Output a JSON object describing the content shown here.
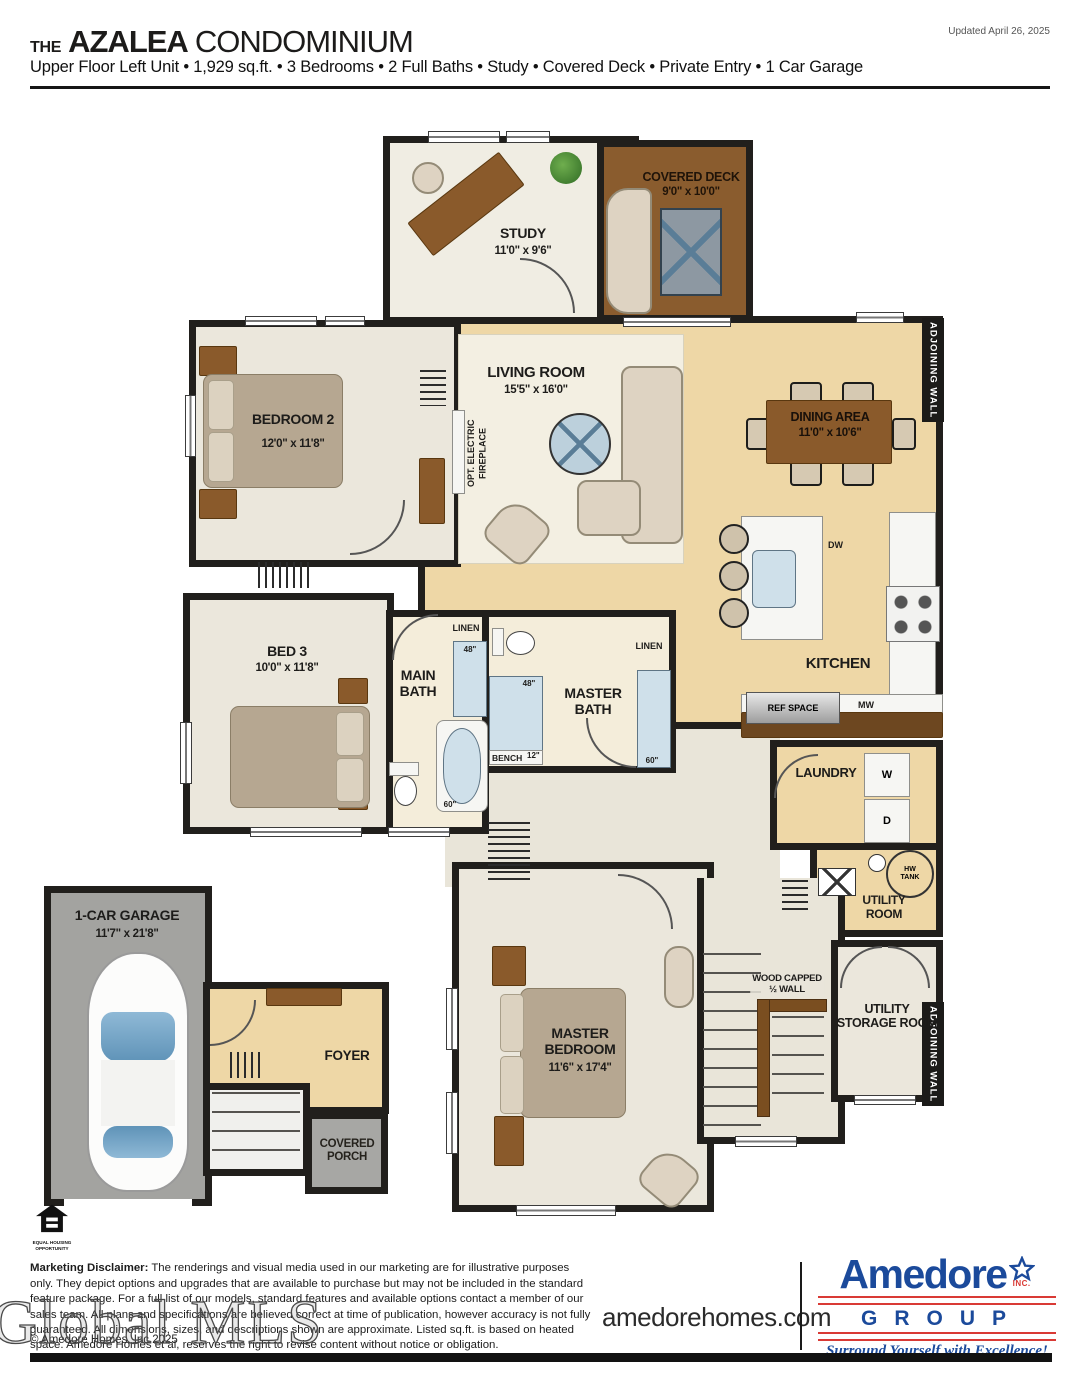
{
  "header": {
    "updated": "Updated April 26, 2025",
    "title": {
      "prefix": "THE",
      "name": "AZALEA",
      "suffix": "CONDOMINIUM"
    },
    "subtitle": "Upper Floor Left Unit • 1,929 sq.ft. • 3 Bedrooms • 2 Full Baths • Study • Covered Deck • Private Entry • 1 Car Garage"
  },
  "plan": {
    "rooms": {
      "study": {
        "name": "STUDY",
        "dims": "11'0\" x 9'6\""
      },
      "covered_deck": {
        "name": "COVERED DECK",
        "dims": "9'0\" x 10'0\""
      },
      "living_room": {
        "name": "LIVING ROOM",
        "dims": "15'5\" x 16'0\""
      },
      "dining_area": {
        "name": "DINING AREA",
        "dims": "11'0\" x 10'6\""
      },
      "kitchen": {
        "name": "KITCHEN"
      },
      "bedroom_2": {
        "name": "BEDROOM 2",
        "dims": "12'0\" x 11'8\""
      },
      "bed_3": {
        "name": "BED 3",
        "dims": "10'0\" x 11'8\""
      },
      "main_bath": {
        "name": "MAIN\nBATH"
      },
      "master_bath": {
        "name": "MASTER\nBATH"
      },
      "laundry": {
        "name": "LAUNDRY"
      },
      "utility_room": {
        "name": "UTILITY\nROOM"
      },
      "master_bedroom": {
        "name": "MASTER\nBEDROOM",
        "dims": "11'6\" x 17'4\""
      },
      "utility_storage": {
        "name": "UTILITY\nSTORAGE ROOM"
      },
      "garage": {
        "name": "1-CAR GARAGE",
        "dims": "11'7\" x 21'8\""
      },
      "foyer": {
        "name": "FOYER"
      },
      "covered_porch": {
        "name": "COVERED\nPORCH"
      }
    },
    "fixtures": {
      "opt_fireplace": "OPT. ELECTRIC\nFIREPLACE",
      "linen_main": "LINEN",
      "linen_master": "LINEN",
      "dw": "DW",
      "mw": "MW",
      "ref_space": "REF SPACE",
      "washer": "W",
      "dryer": "D",
      "hw_tank": "HW\nTANK",
      "bench": "BENCH",
      "wood_capped_wall": "WOOD CAPPED\n½ WALL",
      "adjoining_wall": "ADJOINING WALL",
      "main_vanity_width": "48\"",
      "main_tub_width": "60\"",
      "master_shower_width": "48\"",
      "master_bench_depth": "12\"",
      "master_vanity_width": "60\""
    }
  },
  "footer": {
    "equal_housing": "EQUAL HOUSING\nOPPORTUNITY",
    "disclaimer_label": "Marketing Disclaimer:",
    "disclaimer_text": " The renderings and visual media used in our marketing are for illustrative purposes only. They depict options and upgrades that are available to purchase but may not be included in the standard feature package. For a full list of our models, standard features and available options contact a member of our sales team. All plans and specifications are believed correct at time of publication, however accuracy is not fully guaranteed. All dimensions, sizes, and descriptions shown are approximate. Listed sq.ft. is based on heated space. Amedore Homes et al, reserves the right to revise content without notice or obligation.",
    "copyright": "© Amedore Homes, Inc 2025",
    "watermark": "Global MLS",
    "website": "amedorehomes.com",
    "logo": {
      "brand": "Amedore",
      "inc": "INC.",
      "group": "GROUP",
      "tagline": "Surround Yourself with Excellence!"
    },
    "colors": {
      "brand_blue": "#1b4a9b",
      "brand_red": "#d93a35"
    }
  }
}
